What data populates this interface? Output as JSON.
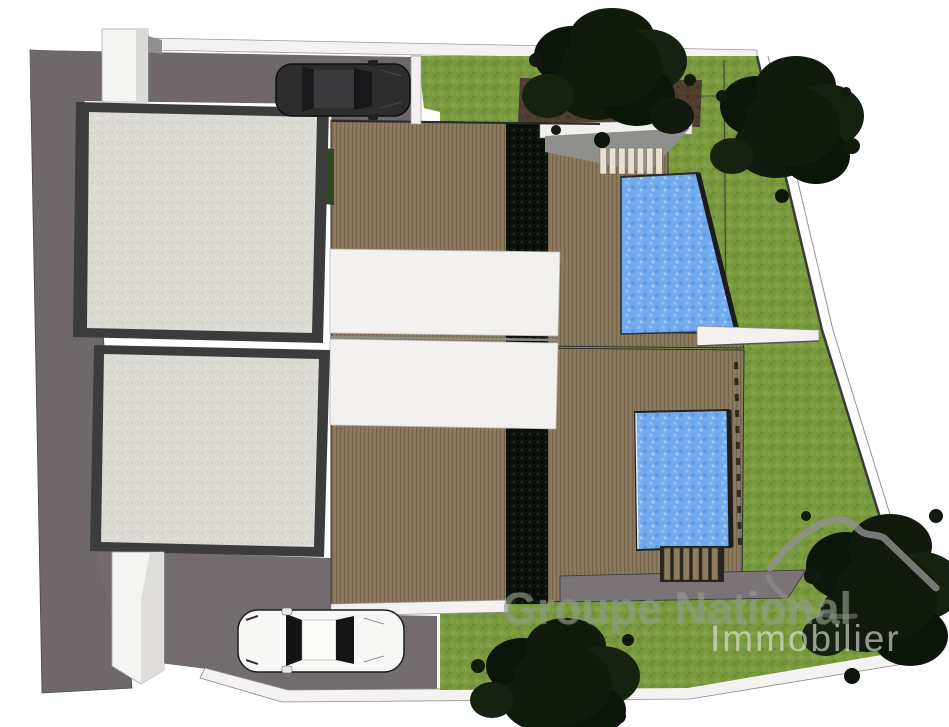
{
  "watermark": {
    "brand_line1": "Groupe National",
    "brand_line2": "Immobilier"
  },
  "scene": {
    "type": "architectural-site-plan-3d-render",
    "description": "Top-down render of a duplex villa plot with two flat roofs, two wooden deck terraces, two swimming pools, lawns, trees, driveway and two parked cars",
    "object_counts": {
      "buildings": 2,
      "pools": 2,
      "cars": 2,
      "trees": 4
    },
    "palette": {
      "background": "#ffffff",
      "wall_gray": "#6f686b",
      "roof_light": "#dcdad5",
      "roof_border": "#3d3c3c",
      "deck_brown": "#8b7a5e",
      "lawn_green": "#79993f",
      "pool_blue": "#73abef",
      "mulch_brown": "#4e3f2f",
      "canopy_white": "#f2f1ef",
      "tree_green": "#111a0d"
    }
  }
}
